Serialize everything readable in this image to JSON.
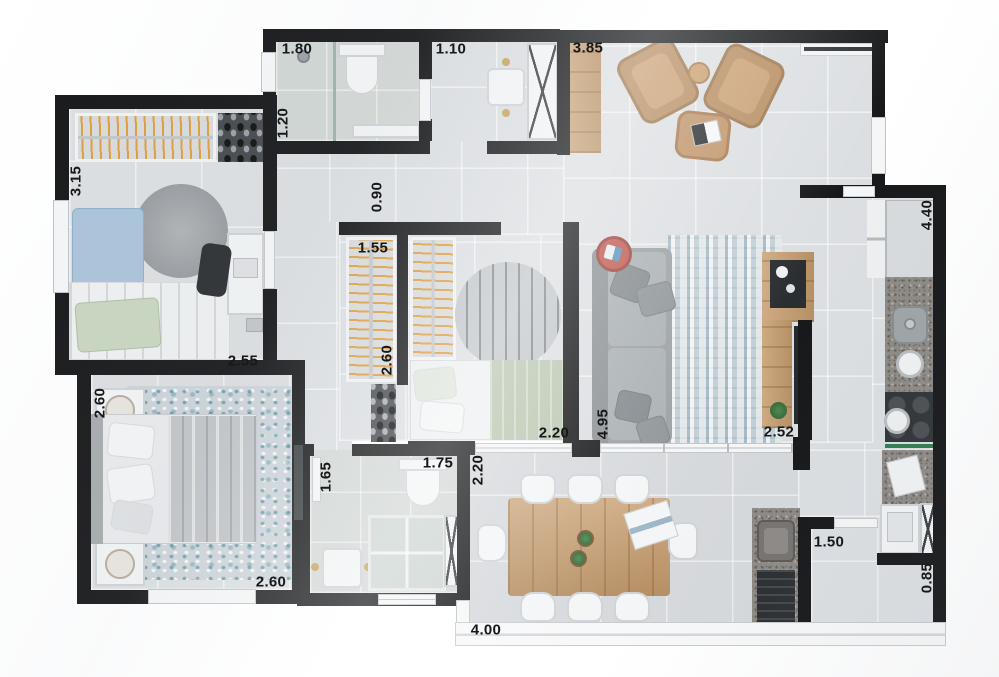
{
  "plan": {
    "width": 999,
    "height": 677,
    "type": "apartment-floor-plan-3d-top-view"
  },
  "colors": {
    "wall": "#17181a",
    "floor": "#dcdfe2",
    "floorBath": "#d3d8d6",
    "floorBalcony": "#d6d9dc",
    "wood": "#c69c6d",
    "hanger": "#dd9e3e",
    "sofa": "#9ba0a3",
    "chairTan": "#b78e63",
    "granite": "#8e8a86",
    "dark": "#2b2e31",
    "sage": "#b9c7b1",
    "blue": "#aac4da",
    "red": "#bf5a50",
    "trim": "#f5f6f7",
    "green": "#2f7d4f",
    "label": "#17181a"
  },
  "dimension_labels": [
    {
      "text": "1.80",
      "x": 297,
      "y": 49,
      "vertical": false
    },
    {
      "text": "1.10",
      "x": 451,
      "y": 49,
      "vertical": false
    },
    {
      "text": "3.85",
      "x": 588,
      "y": 48,
      "vertical": false
    },
    {
      "text": "1.20",
      "x": 283,
      "y": 123,
      "vertical": true
    },
    {
      "text": "3.15",
      "x": 76,
      "y": 181,
      "vertical": true
    },
    {
      "text": "0.90",
      "x": 377,
      "y": 197,
      "vertical": true
    },
    {
      "text": "1.55",
      "x": 373,
      "y": 248,
      "vertical": false
    },
    {
      "text": "2.60",
      "x": 387,
      "y": 360,
      "vertical": true
    },
    {
      "text": "2.55",
      "x": 243,
      "y": 361,
      "vertical": false
    },
    {
      "text": "2.60",
      "x": 100,
      "y": 403,
      "vertical": true
    },
    {
      "text": "2.60",
      "x": 271,
      "y": 582,
      "vertical": false
    },
    {
      "text": "2.20",
      "x": 554,
      "y": 433,
      "vertical": false
    },
    {
      "text": "4.95",
      "x": 603,
      "y": 424,
      "vertical": true
    },
    {
      "text": "2.52",
      "x": 779,
      "y": 432,
      "vertical": false
    },
    {
      "text": "4.40",
      "x": 927,
      "y": 215,
      "vertical": true
    },
    {
      "text": "1.50",
      "x": 829,
      "y": 542,
      "vertical": false
    },
    {
      "text": "0.85",
      "x": 927,
      "y": 578,
      "vertical": true
    },
    {
      "text": "1.65",
      "x": 326,
      "y": 477,
      "vertical": true
    },
    {
      "text": "1.75",
      "x": 438,
      "y": 463,
      "vertical": false
    },
    {
      "text": "2.20",
      "x": 478,
      "y": 470,
      "vertical": true
    },
    {
      "text": "4.00",
      "x": 486,
      "y": 630,
      "vertical": false
    }
  ]
}
